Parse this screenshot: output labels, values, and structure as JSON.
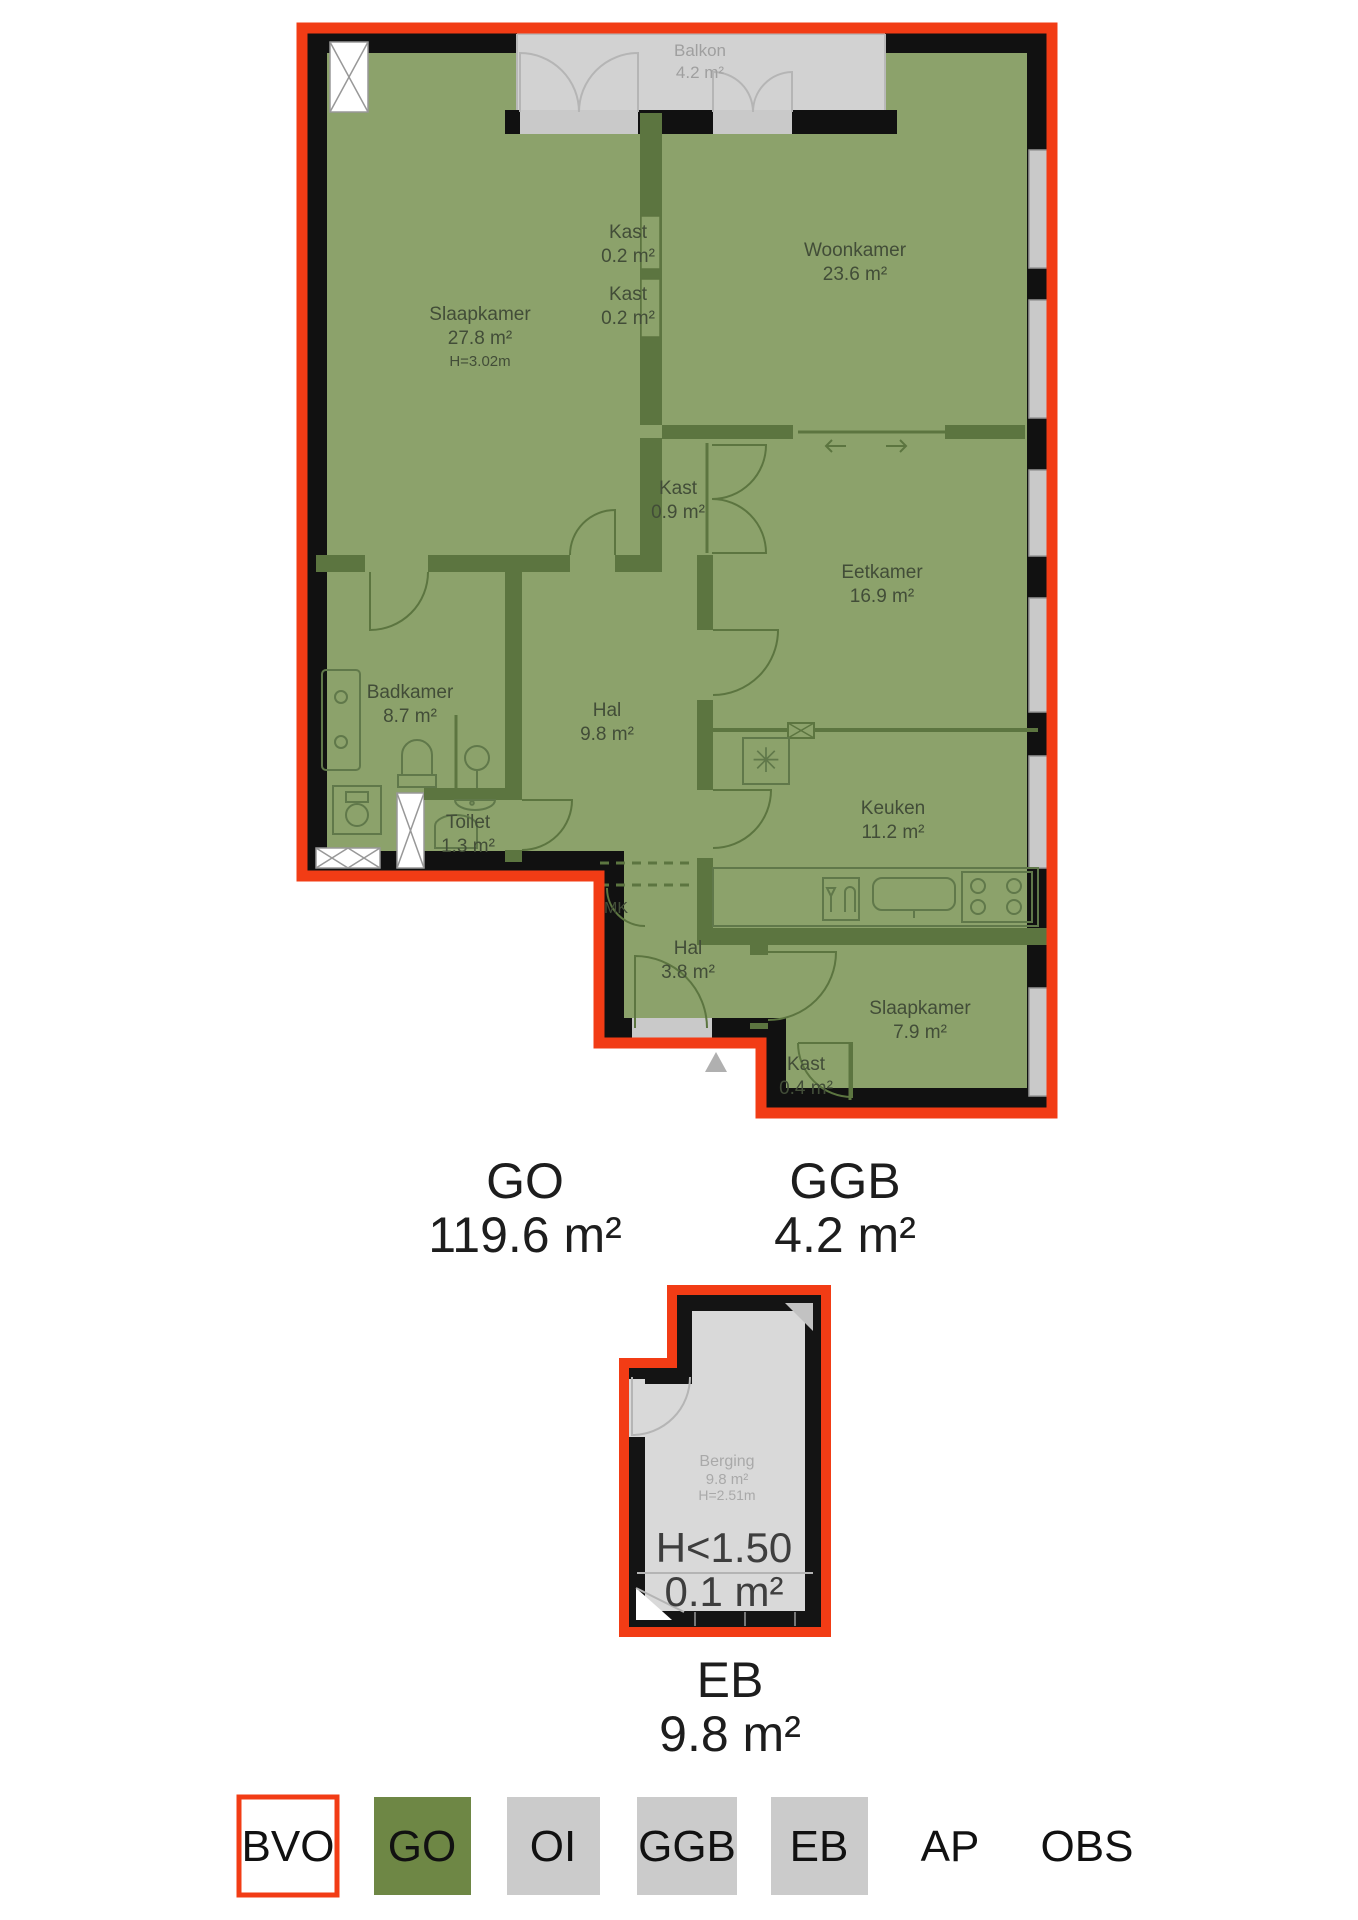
{
  "main": {
    "rooms": {
      "balkon": {
        "name": "Balkon",
        "area": "4.2 m²"
      },
      "slaapkamer1": {
        "name": "Slaapkamer",
        "area": "27.8 m²",
        "ceiling": "H=3.02m"
      },
      "kast_a": {
        "name": "Kast",
        "area": "0.2 m²"
      },
      "kast_b": {
        "name": "Kast",
        "area": "0.2 m²"
      },
      "woonkamer": {
        "name": "Woonkamer",
        "area": "23.6 m²"
      },
      "kast_c": {
        "name": "Kast",
        "area": "0.9 m²"
      },
      "eetkamer": {
        "name": "Eetkamer",
        "area": "16.9 m²"
      },
      "badkamer": {
        "name": "Badkamer",
        "area": "8.7 m²"
      },
      "hal1": {
        "name": "Hal",
        "area": "9.8 m²"
      },
      "toilet": {
        "name": "Toilet",
        "area": "1.3 m²"
      },
      "keuken": {
        "name": "Keuken",
        "area": "11.2 m²"
      },
      "mk": {
        "name": "MK"
      },
      "hal2": {
        "name": "Hal",
        "area": "3.8 m²"
      },
      "slaapkamer2": {
        "name": "Slaapkamer",
        "area": "7.9 m²"
      },
      "kast_d": {
        "name": "Kast",
        "area": "0.4 m²"
      }
    },
    "totals": {
      "go": {
        "code": "GO",
        "area": "119.6 m²"
      },
      "ggb": {
        "code": "GGB",
        "area": "4.2 m²"
      }
    }
  },
  "storage": {
    "room": {
      "name": "Berging",
      "area": "9.8 m²",
      "ceiling": "H=2.51m"
    },
    "low_headroom": {
      "label": "H<1.50",
      "area": "0.1 m²"
    },
    "total": {
      "code": "EB",
      "area": "9.8 m²"
    }
  },
  "legend": {
    "items": [
      {
        "label": "BVO",
        "style": "outlined"
      },
      {
        "label": "GO",
        "style": "green"
      },
      {
        "label": "OI",
        "style": "gray"
      },
      {
        "label": "GGB",
        "style": "gray"
      },
      {
        "label": "EB",
        "style": "gray"
      },
      {
        "label": "AP",
        "style": "plain"
      },
      {
        "label": "OBS",
        "style": "plain"
      }
    ]
  },
  "colors": {
    "bvo_outline": "#f23c15",
    "go_green": "#8ca26b",
    "wall_black": "#111111",
    "interior_wall": "#5c7540",
    "balcony_gray": "#d2d2d2",
    "storage_gray": "#d9d9d9",
    "legend_green": "#6e8745",
    "legend_gray": "#cbcbcb"
  }
}
